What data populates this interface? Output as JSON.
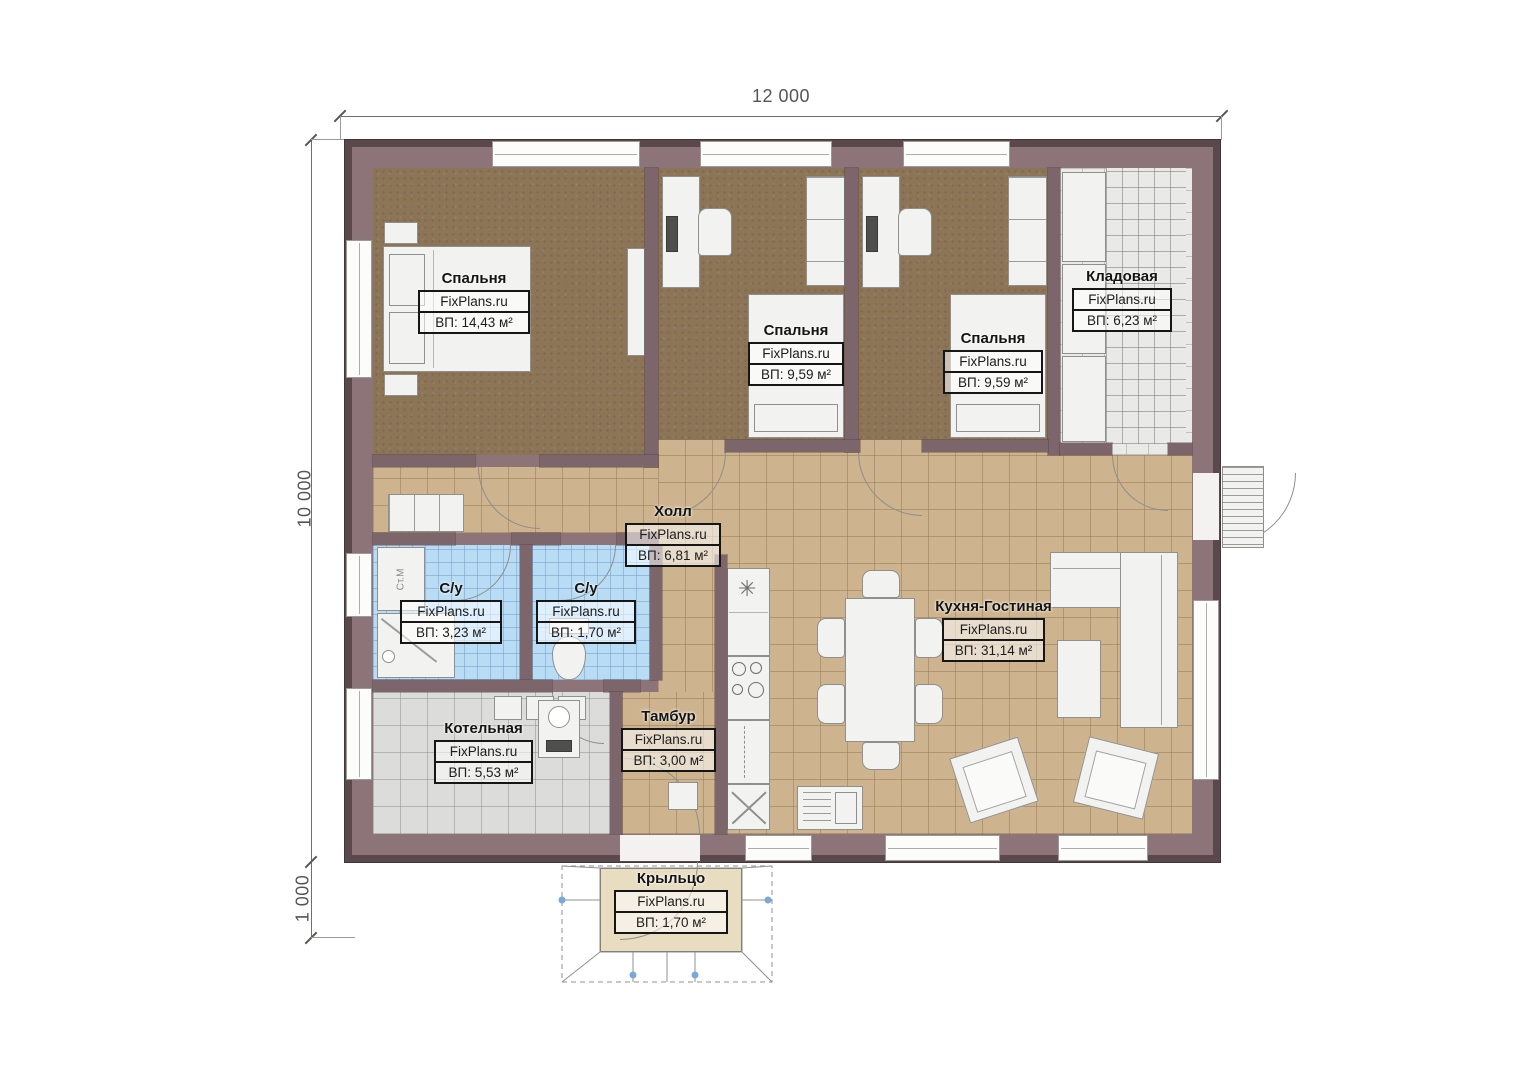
{
  "dimensions": {
    "width_label": "12 000",
    "height_label": "10 000",
    "porch_height_label": "1 000"
  },
  "rooms": [
    {
      "name": "Спальня",
      "watermark": "FixPlans.ru",
      "area": "ВП: 14,43 м²"
    },
    {
      "name": "Спальня",
      "watermark": "FixPlans.ru",
      "area": "ВП: 9,59 м²"
    },
    {
      "name": "Спальня",
      "watermark": "FixPlans.ru",
      "area": "ВП: 9,59 м²"
    },
    {
      "name": "Кладовая",
      "watermark": "FixPlans.ru",
      "area": "ВП: 6,23 м²"
    },
    {
      "name": "Холл",
      "watermark": "FixPlans.ru",
      "area": "ВП: 6,81 м²"
    },
    {
      "name": "С/у",
      "watermark": "FixPlans.ru",
      "area": "ВП: 3,23 м²"
    },
    {
      "name": "С/у",
      "watermark": "FixPlans.ru",
      "area": "ВП: 1,70 м²"
    },
    {
      "name": "Котельная",
      "watermark": "FixPlans.ru",
      "area": "ВП: 5,53 м²"
    },
    {
      "name": "Тамбур",
      "watermark": "FixPlans.ru",
      "area": "ВП: 3,00 м²"
    },
    {
      "name": "Кухня-Гостиная",
      "watermark": "FixPlans.ru",
      "area": "ВП: 31,14 м²"
    },
    {
      "name": "Крыльцо",
      "watermark": "FixPlans.ru",
      "area": "ВП: 1,70 м²"
    }
  ],
  "fixtures": {
    "washing_machine_label": "Ст.М"
  },
  "icons": {
    "ceiling_light": "✳"
  },
  "colors": {
    "wall": "#8d7478",
    "wall_outline": "#5b484c",
    "bedroom_floor": "#8c7457",
    "tile_beige": "#cdb48e",
    "tile_blue": "#b9dcf5",
    "tile_gray": "#dcdcda",
    "tile_storage": "#e9e9e7",
    "porch_pad": "#e9ddc1",
    "furniture": "#f2f2f0",
    "marker_blue": "#7aa8d8"
  }
}
